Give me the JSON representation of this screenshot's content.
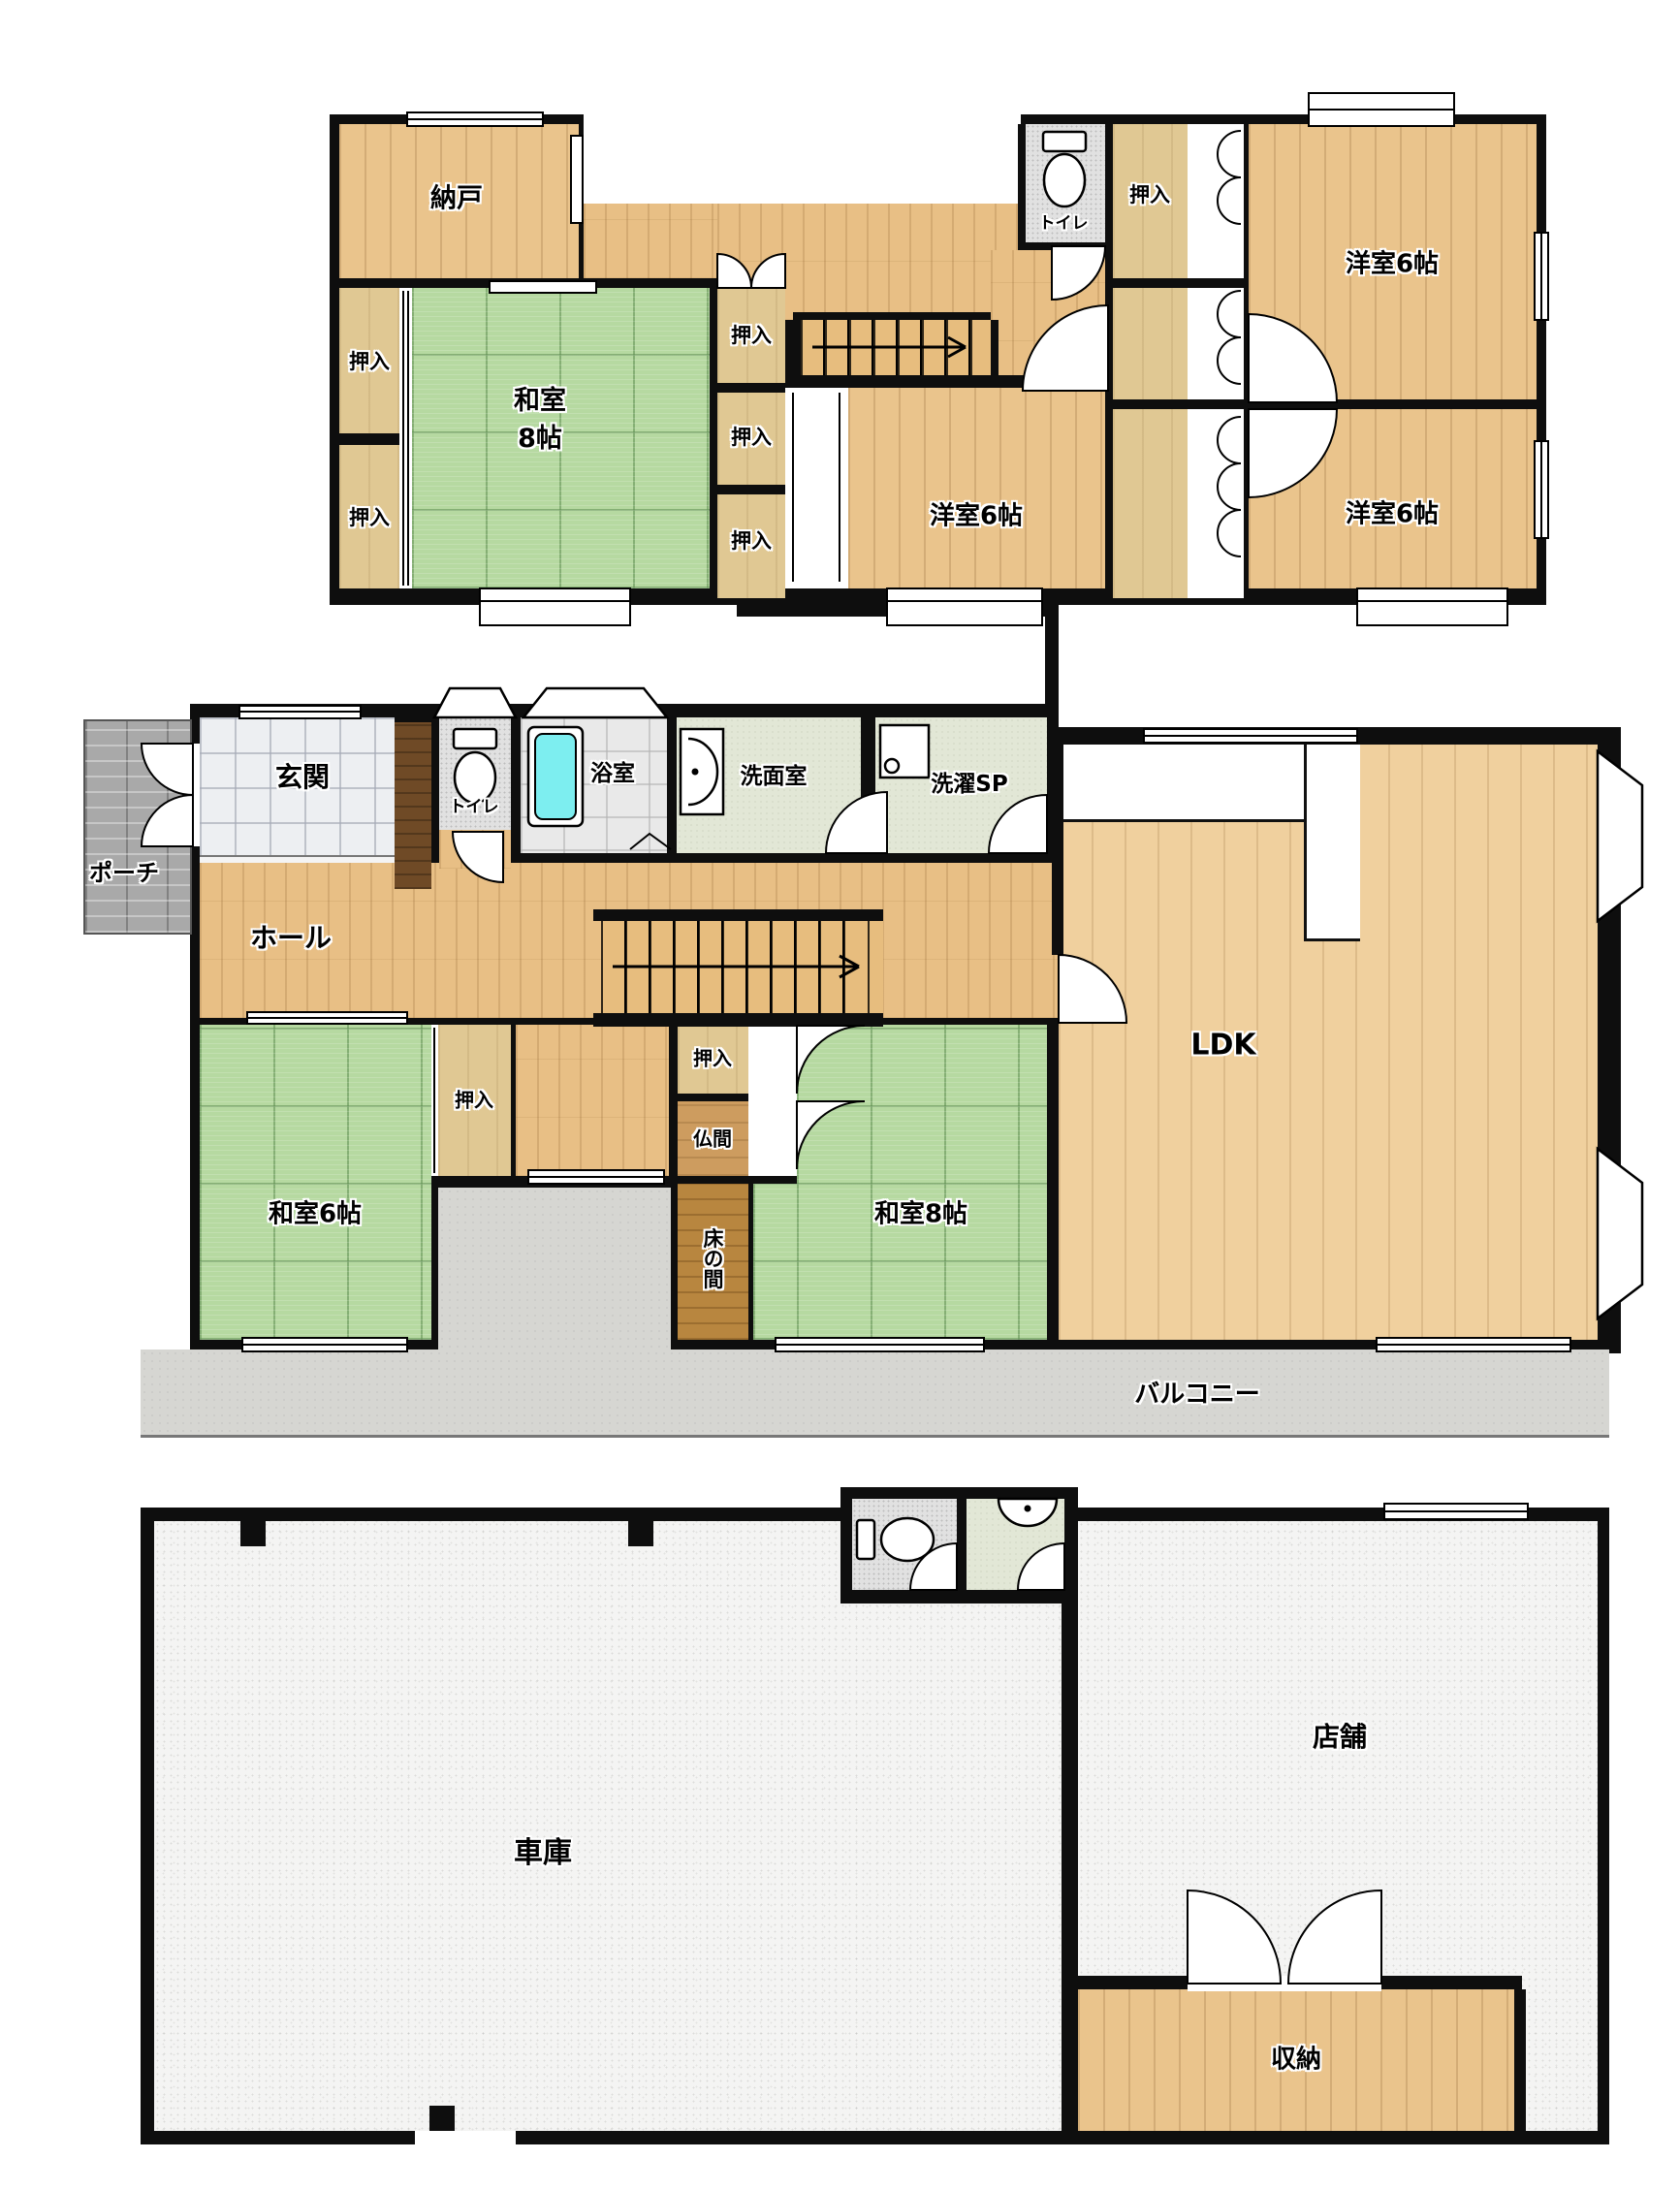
{
  "floor2f": {
    "nando": "納戸",
    "oshiire": "押入",
    "washitsu8_line1": "和室",
    "washitsu8_line2": "8帖",
    "toilet": "トイレ",
    "yoshitsu6": "洋室6帖"
  },
  "floor1f": {
    "porch": "ポーチ",
    "genkan": "玄関",
    "toilet": "トイレ",
    "bath": "浴室",
    "senmen": "洗面室",
    "sentaku": "洗濯SP",
    "hall": "ホール",
    "ldk": "LDK",
    "washitsu6": "和室6帖",
    "oshiire": "押入",
    "butsuma": "仏間",
    "tokonoma": "床の間",
    "washitsu8": "和室8帖",
    "balcony": "バルコニー"
  },
  "floorb": {
    "garage": "車庫",
    "shop": "店舗",
    "shuno": "収納"
  }
}
